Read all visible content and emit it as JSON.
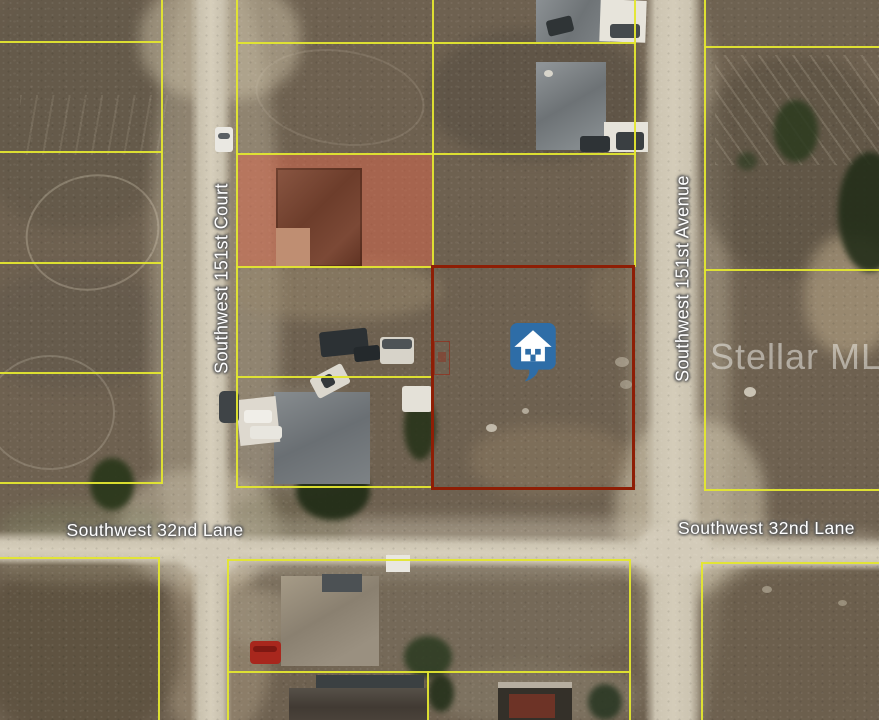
{
  "map": {
    "streets": {
      "court": "Southwest 151st Court",
      "avenue": "Southwest 151st Avenue",
      "lane_west": "Southwest 32nd Lane",
      "lane_east": "Southwest 32nd Lane"
    },
    "watermark": "Stellar MLS",
    "icons": {
      "subject_pin": "house-pin-icon"
    },
    "colors": {
      "parcel_line": "#e3e630",
      "subject_parcel_border": "#8e1e05",
      "highlight_overlay": "rgba(221,104,76,0.5)",
      "pin_fill": "#2e6da7",
      "pin_glyph": "#ffffff",
      "road": "#d6cebb"
    }
  }
}
